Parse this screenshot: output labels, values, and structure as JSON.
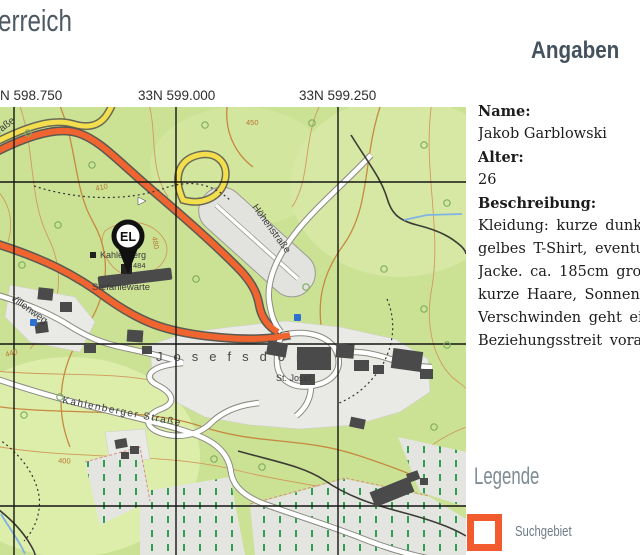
{
  "title_fragment": "erreich",
  "panel": {
    "heading": "Angaben",
    "name_label": "Name:",
    "name": "Jakob Garblowski",
    "age_label": "Alter:",
    "age": "26",
    "desc_label": "Beschreibung:",
    "desc_lines": [
      "Kleidung: kurze dunkl",
      "gelbes T-Shirt, eventue",
      "Jacke. ca. 185cm groß,",
      "kurze Haare, Sonnenbr",
      "Verschwinden geht ein",
      "Beziehungsstreit voraus"
    ]
  },
  "grid_labels": [
    "N 598.750",
    "33N 599.000",
    "33N 599.250"
  ],
  "legend": {
    "title": "Legende",
    "item": "Suchgebiet",
    "swatch_color": "#f15b2d"
  },
  "map": {
    "marker": "EL",
    "labels": {
      "kahlenberg": "Kahlenberg",
      "elevation": "484",
      "stefaniewarte": "Stefaniewarte",
      "villenweg": "Villenweg",
      "josefsdorf": "Josefsdorf",
      "st_josef": "St. Josef",
      "kahlenberger_strasse": "Kahlenberger Straße",
      "hoehenstrasse": "Höhenstraße",
      "hoehenstrasse_nw": "Höhenstraße"
    },
    "contour_labels": [
      "450",
      "410",
      "480",
      "440",
      "400"
    ],
    "colors": {
      "ground": "#cbe295",
      "main_road": "#f0642f",
      "secondary_road": "#f3de4e",
      "contour": "#d09a5c"
    }
  }
}
